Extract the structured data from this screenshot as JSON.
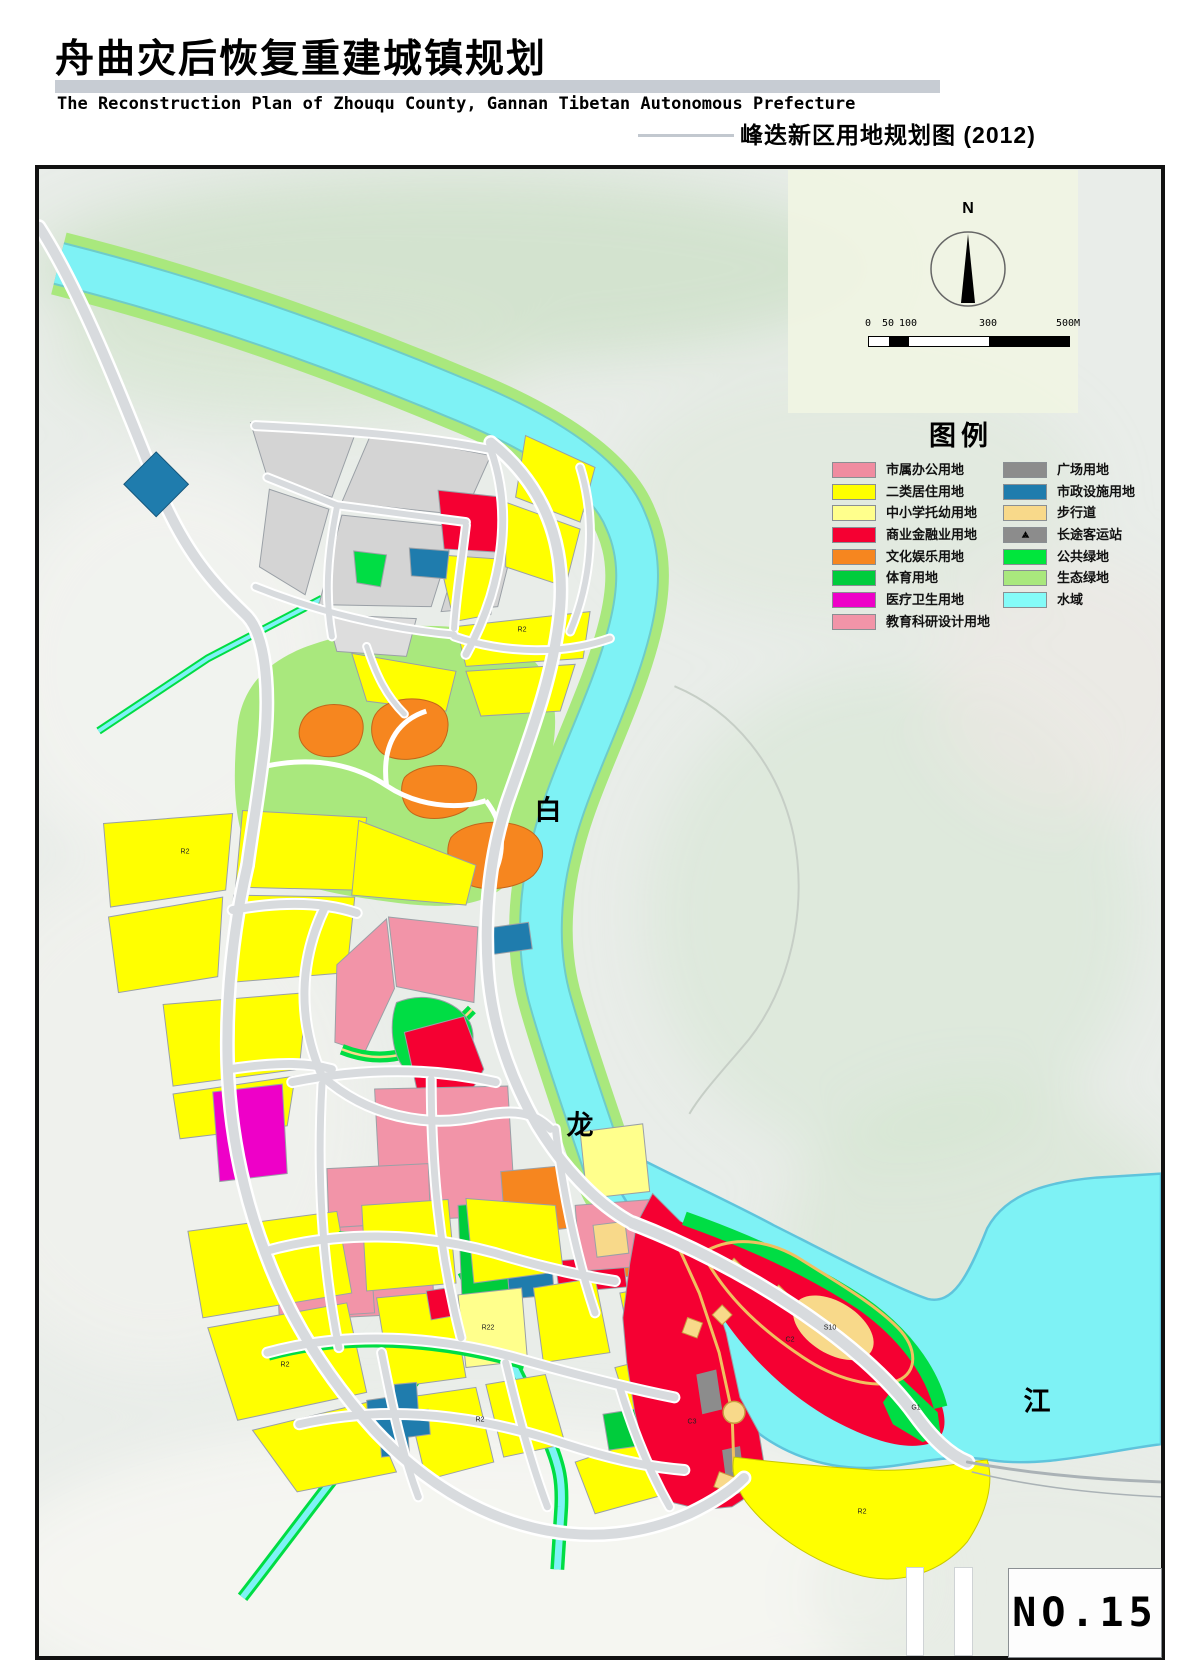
{
  "header": {
    "title_cn": "舟曲灾后恢复重建城镇规划",
    "title_en": "The Reconstruction Plan of Zhouqu County, Gannan Tibetan Autonomous Prefecture",
    "map_subtitle": "峰迭新区用地规划图 (2012)"
  },
  "compass": {
    "label": "N"
  },
  "scale_bar": {
    "ticks": [
      "0",
      "50",
      "100",
      "300",
      "500M"
    ]
  },
  "legend": {
    "title": "图例",
    "left": [
      {
        "label": "市属办公用地",
        "color": "#F08CA0"
      },
      {
        "label": "二类居住用地",
        "color": "#FFFF00"
      },
      {
        "label": "中小学托幼用地",
        "color": "#FFFF8C"
      },
      {
        "label": "商业金融业用地",
        "color": "#F50032"
      },
      {
        "label": "文化娱乐用地",
        "color": "#F6861F"
      },
      {
        "label": "体育用地",
        "color": "#00CC3C"
      },
      {
        "label": "医疗卫生用地",
        "color": "#EE00C8"
      },
      {
        "label": "教育科研设计用地",
        "color": "#F294A8"
      }
    ],
    "right": [
      {
        "label": "广场用地",
        "color": "#8C8C8C"
      },
      {
        "label": "市政设施用地",
        "color": "#1F7CAD"
      },
      {
        "label": "步行道",
        "color": "#F8D98A"
      },
      {
        "label": "长途客运站",
        "color": "#8C8C8C",
        "icon": "bus-station"
      },
      {
        "label": "公共绿地",
        "color": "#00E63C"
      },
      {
        "label": "生态绿地",
        "color": "#A9E87D"
      },
      {
        "label": "水域",
        "color": "#84FBF8"
      }
    ]
  },
  "map": {
    "river_labels": [
      {
        "char": "白"
      },
      {
        "char": "龙"
      },
      {
        "char": "江"
      }
    ],
    "parcel_codes": [
      "R2",
      "R2",
      "R2",
      "R2",
      "R22",
      "C2",
      "C3",
      "G1",
      "S10",
      "R2"
    ],
    "sheet_no": "NO.15",
    "palette": {
      "water": "#7EF2F5",
      "eco_green": "#A9E87D",
      "public_green": "#00DD44",
      "residential_yellow": "#FFFF00",
      "commercial_red": "#F50032",
      "education_pink": "#F294A8",
      "culture_orange": "#F6861F",
      "health_magenta": "#EE00C8",
      "utility_blue": "#1F7CAD",
      "walkway_tan": "#F8D98A",
      "square_gray": "#8C8C8C",
      "road_gray": "#D8DBDE"
    }
  }
}
